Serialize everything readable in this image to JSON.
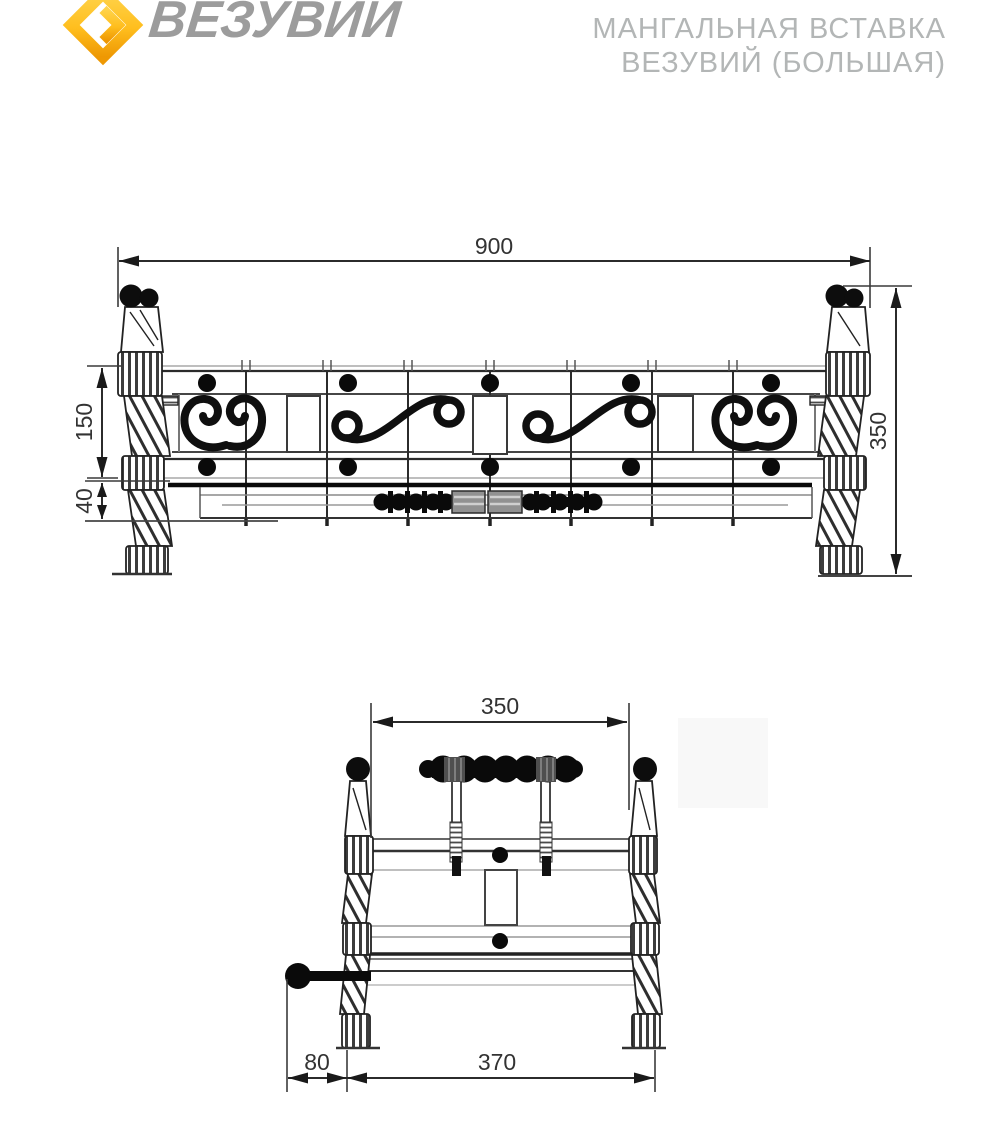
{
  "header": {
    "brand": "ВЕЗУВИЙ",
    "title_line1": "МАНГАЛЬНАЯ ВСТАВКА",
    "title_line2": "ВЕЗУВИЙ (БОЛЬШАЯ)"
  },
  "colors": {
    "logo_yellow": "#FFD34A",
    "logo_orange": "#EE9803",
    "brand_gray": "#9c9c9c",
    "title_gray": "#b3b6b6",
    "line_dark": "#2b2b2b"
  },
  "drawing": {
    "front_view": {
      "label": "front-view",
      "dims": {
        "overall_width": "900",
        "overall_height": "350",
        "panel_height": "150",
        "tray_height": "40"
      }
    },
    "side_view": {
      "label": "side-view",
      "dims": {
        "frame_width": "350",
        "base_width": "370",
        "handle_offset": "80"
      }
    }
  }
}
